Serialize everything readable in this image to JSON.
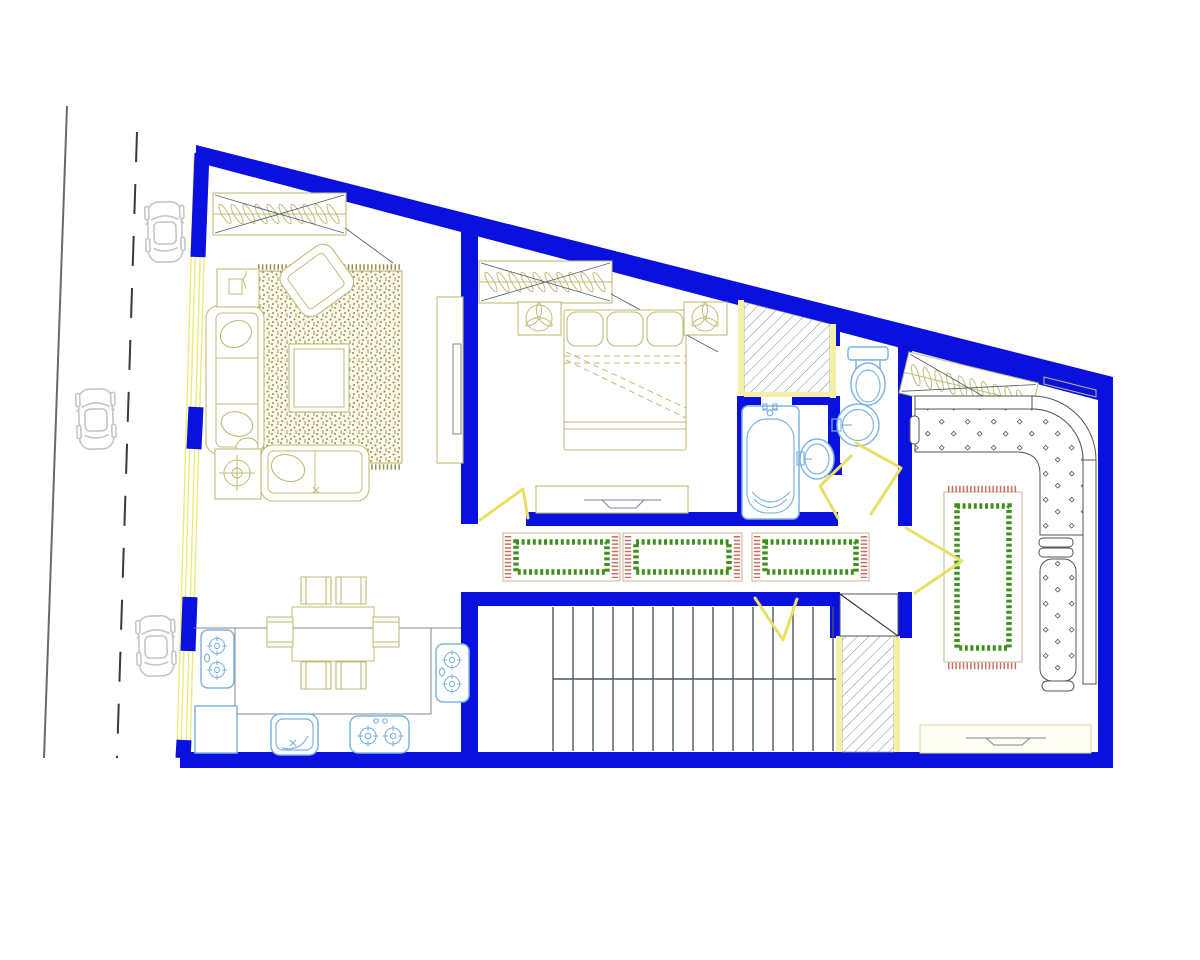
{
  "scene": {
    "description": "Architectural floor plan of an apartment drawn in CAD style, with a street and three parked cars on the left",
    "drawing_has_text": false
  },
  "colors": {
    "wall": "#0a10dd",
    "window": "#efe87d",
    "door_swing": "#e9df67",
    "shaft_border": "#f4f0a6",
    "fixture": "#7fb5e3",
    "furniture": "#c2bb77",
    "rug_texture": "#97904a",
    "rug_green": "#3f8f1d",
    "rug_fringe_red": "#cc6e5f",
    "stairs": "#4a5560",
    "car": "#c6c6c6",
    "street_line": "#6a6a6a",
    "background": "#ffffff"
  },
  "street": {
    "parked_cars": 3,
    "marking": "dashed-center-line"
  },
  "rooms": {
    "living_room": {
      "items": [
        "closet-with-hangers",
        "textured-area-rug",
        "coffee-table",
        "three-seat-sofa",
        "loveseat",
        "armchair",
        "side-table",
        "floor-lamp",
        "tv-unit"
      ]
    },
    "bedroom": {
      "items": [
        "closet-with-hangers",
        "double-bed",
        "nightstand-with-fan-lamp",
        "nightstand-with-fan-lamp",
        "dresser-with-tv"
      ]
    },
    "bathroom": {
      "items": [
        "bathtub",
        "oval-washbasin"
      ]
    },
    "wc": {
      "items": [
        "toilet",
        "round-washbasin"
      ]
    },
    "hallway": {
      "items": [
        "runner-rug",
        "runner-rug",
        "runner-rug"
      ]
    },
    "staircase": {
      "treads": 15,
      "flights": 2
    },
    "kitchen_dining": {
      "items": [
        "dining-table",
        "chair",
        "chair",
        "chair",
        "chair",
        "chair",
        "chair",
        "island-counter",
        "cooktop",
        "cooktop",
        "cooktop",
        "kitchen-sink",
        "appliance"
      ]
    },
    "lounge": {
      "items": [
        "closet-with-hangers",
        "l-shaped-sofa",
        "ornate-rug",
        "tv-console",
        "wall-shelf"
      ]
    }
  },
  "shafts": 2,
  "door_swings": 5
}
